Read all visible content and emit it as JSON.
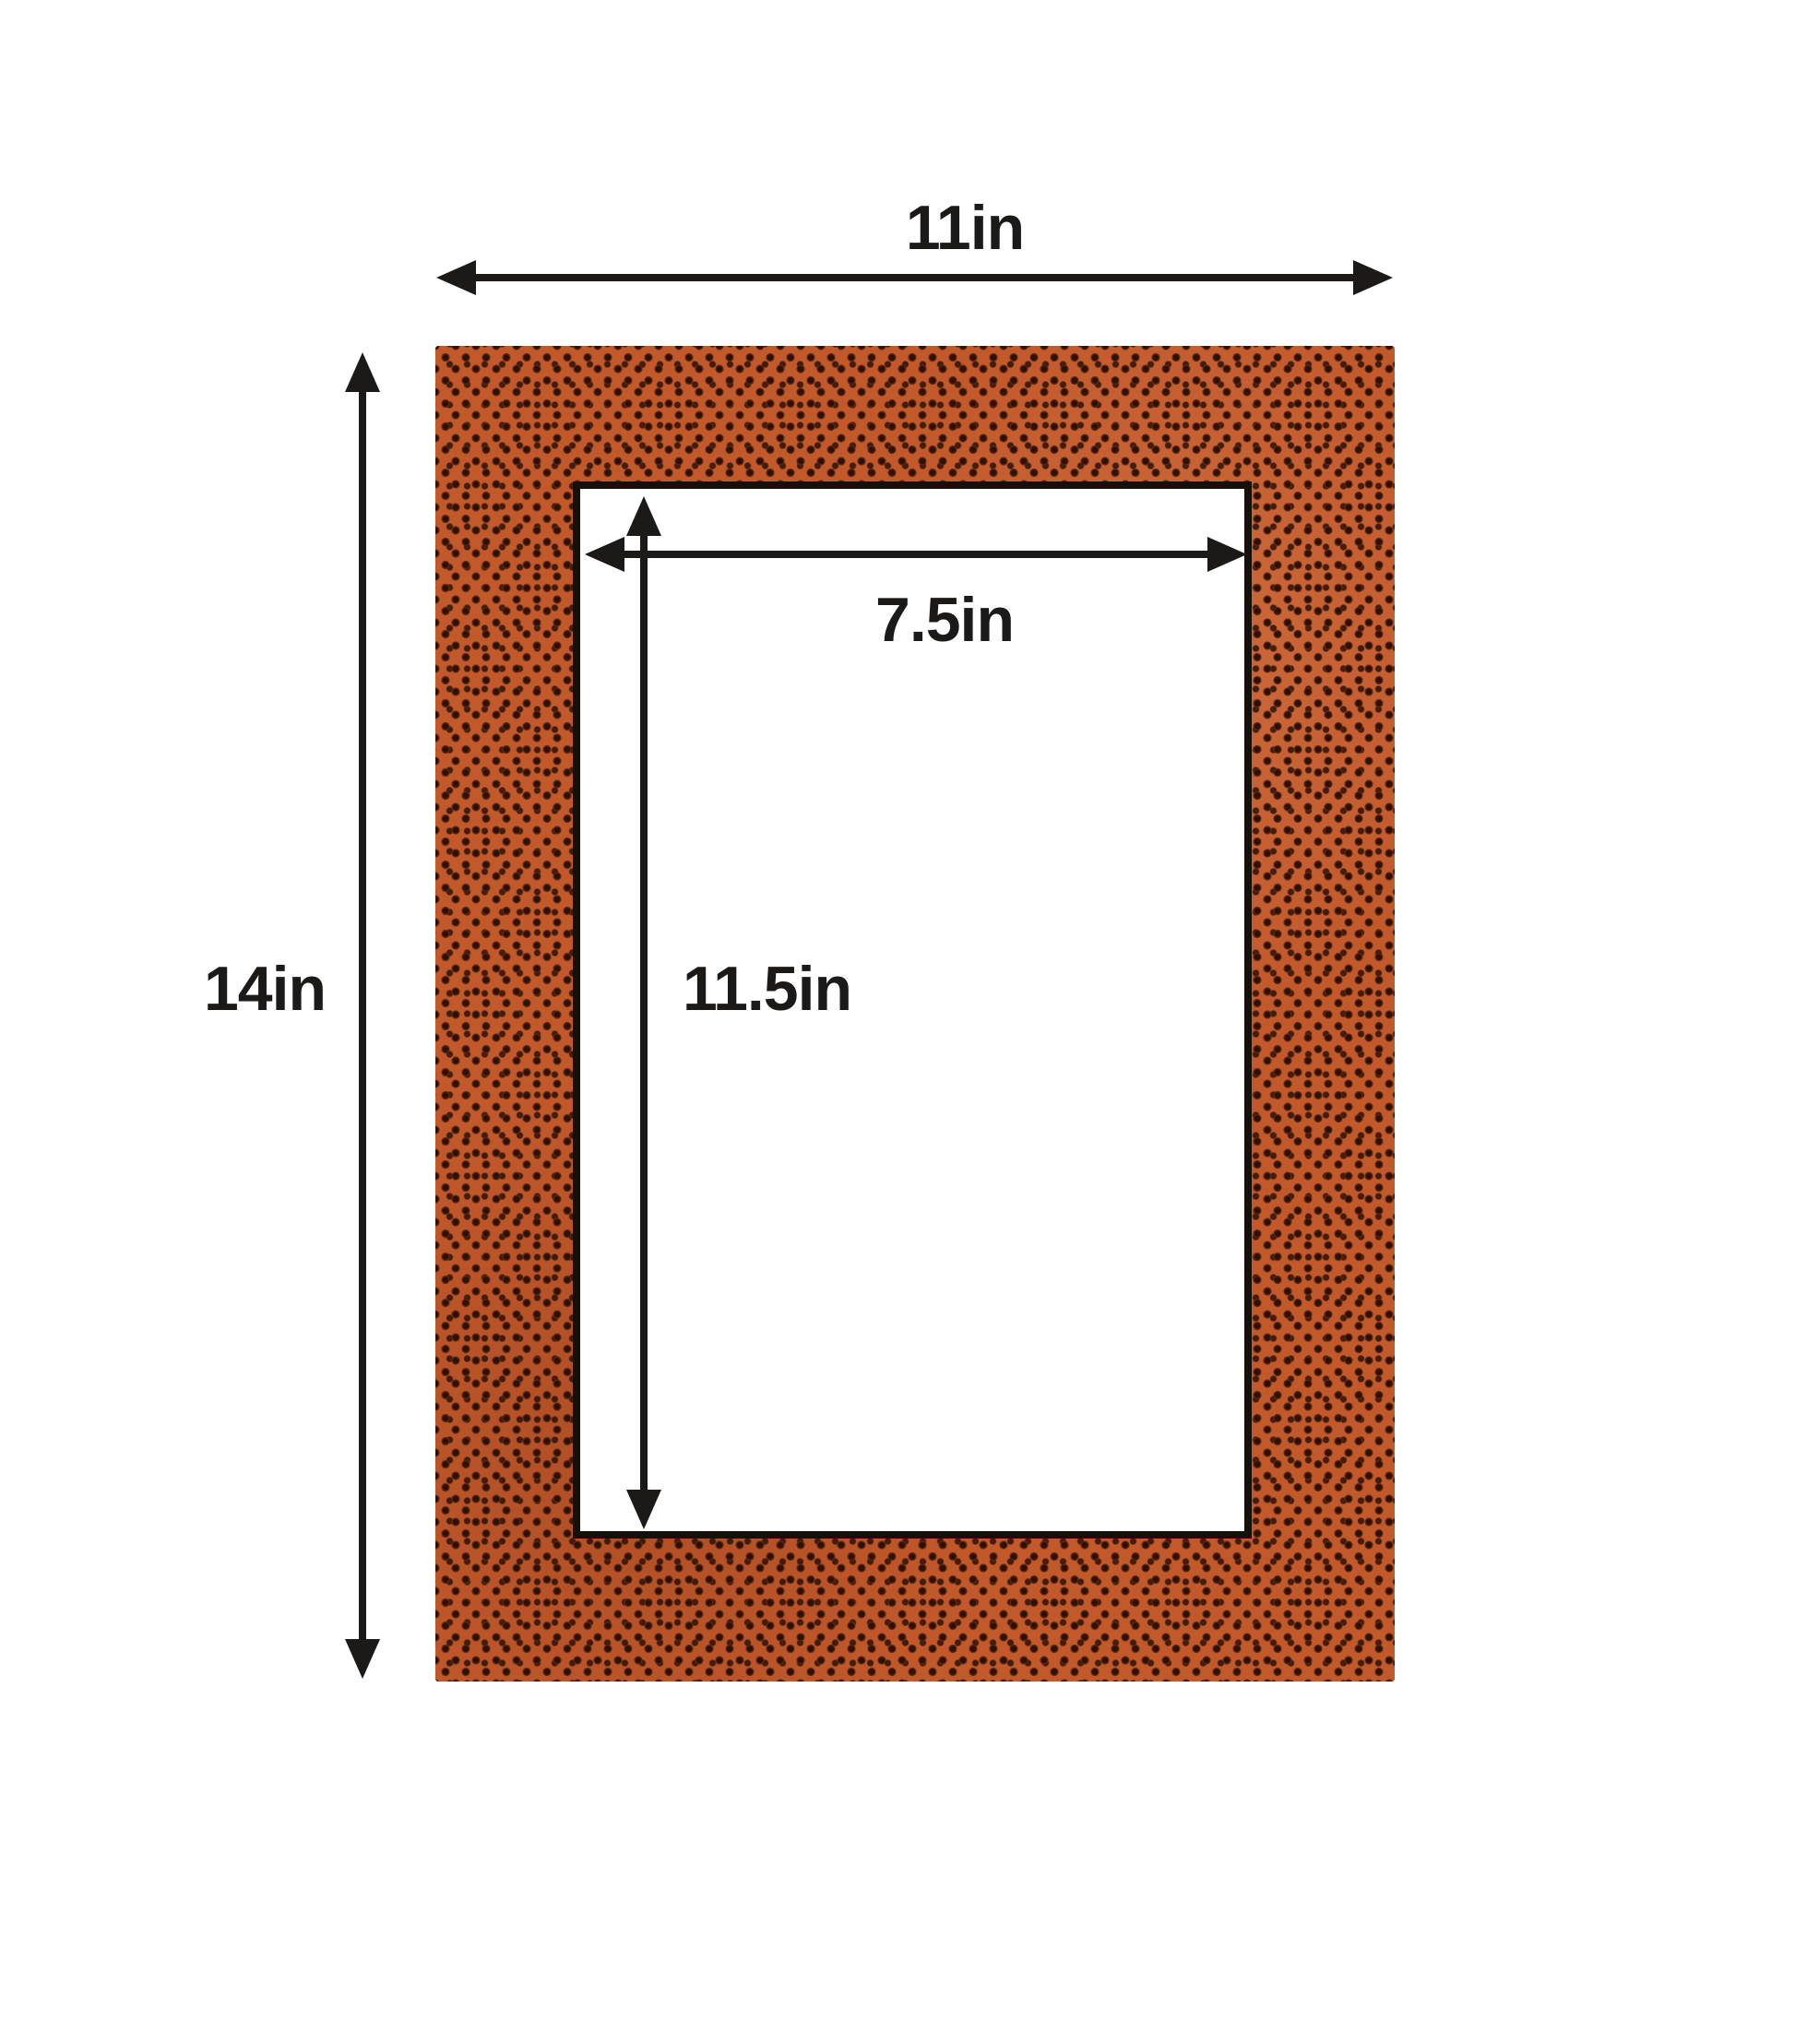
{
  "labels": {
    "outer_width": "11in",
    "outer_height": "14in",
    "opening_width": "7.5in",
    "opening_height": "11.5in"
  },
  "colors": {
    "background": "#ffffff",
    "mat_base": "#c2592b",
    "mat_dot": "#2b1107",
    "mat_dot_ring": "#5a2410",
    "opening_border": "#15100b",
    "arrow": "#1b1a18",
    "label_text": "#1b1a18"
  }
}
